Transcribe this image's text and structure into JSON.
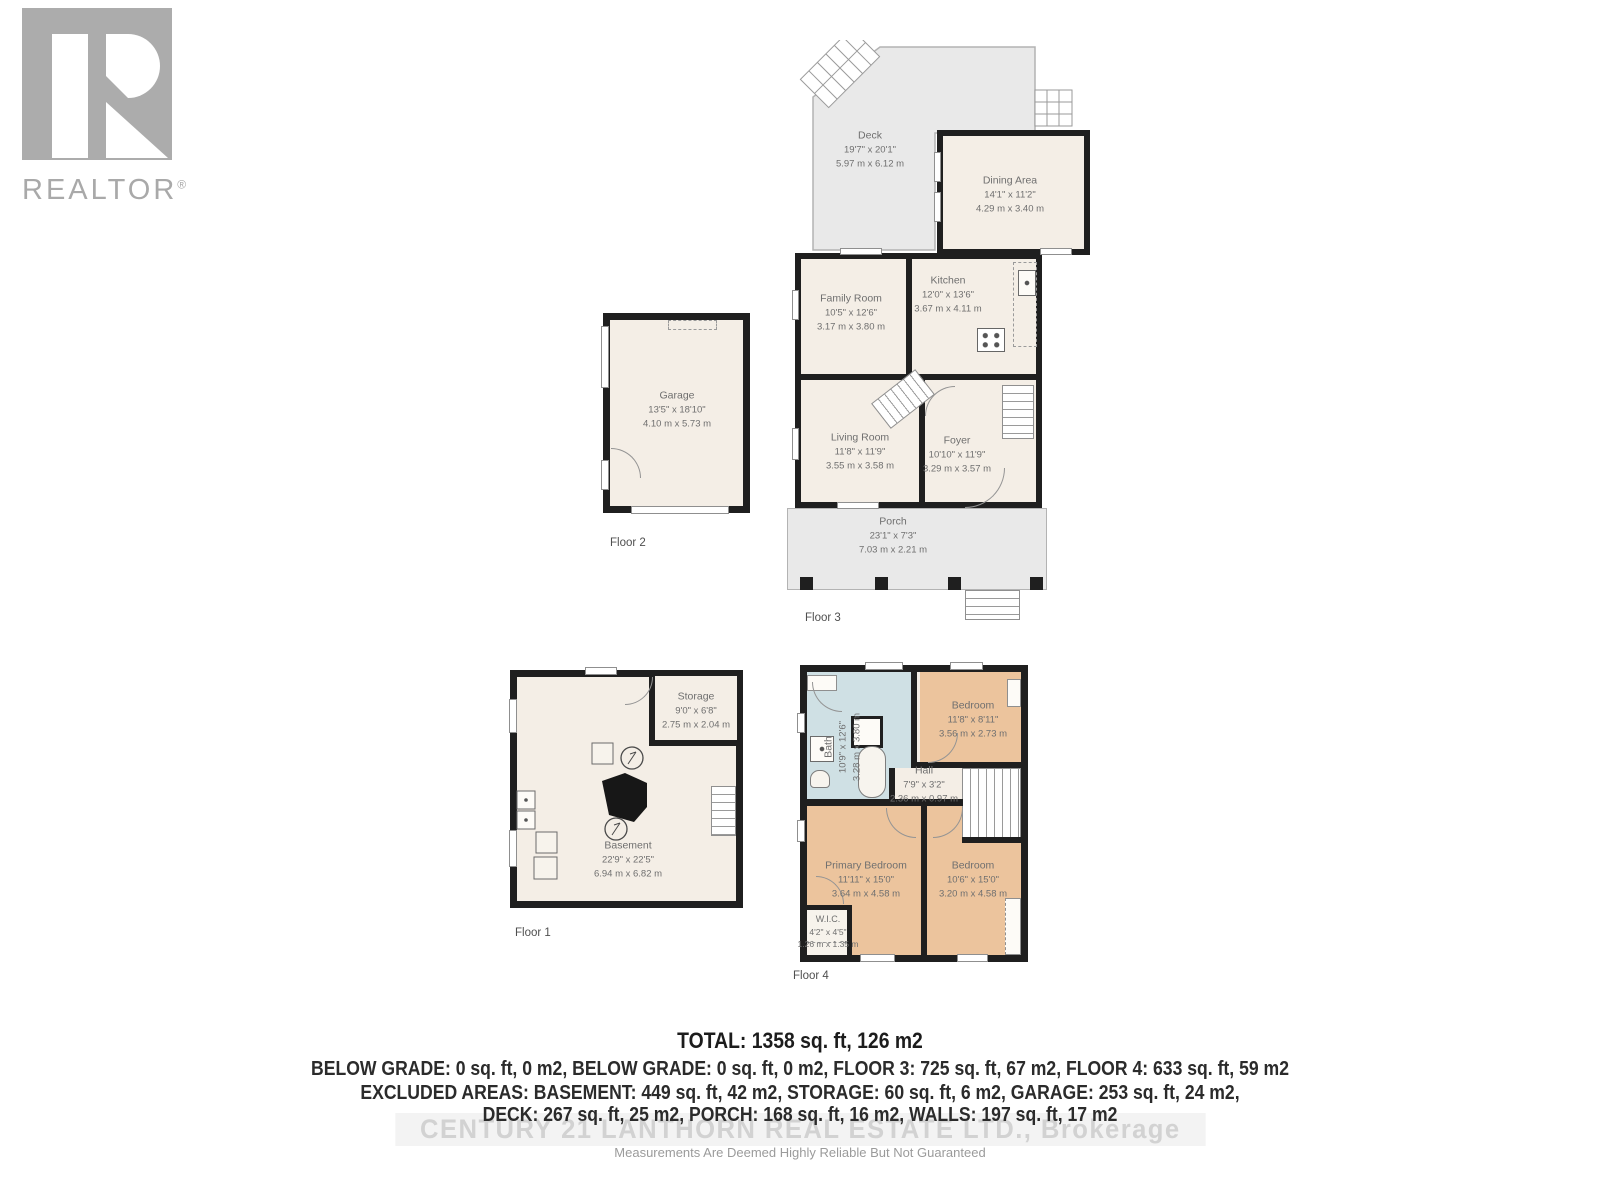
{
  "logo": {
    "brand": "REALTOR",
    "registered": "®"
  },
  "floors": [
    {
      "label": "Floor 3",
      "rooms": [
        {
          "name": "Deck",
          "imperial": "19'7\" x 20'1\"",
          "metric": "5.97 m x 6.12 m"
        },
        {
          "name": "Dining Area",
          "imperial": "14'1\" x 11'2\"",
          "metric": "4.29 m x 3.40 m"
        },
        {
          "name": "Family Room",
          "imperial": "10'5\" x 12'6\"",
          "metric": "3.17 m x 3.80 m"
        },
        {
          "name": "Kitchen",
          "imperial": "12'0\" x 13'6\"",
          "metric": "3.67 m x 4.11 m"
        },
        {
          "name": "Living Room",
          "imperial": "11'8\" x 11'9\"",
          "metric": "3.55 m x 3.58 m"
        },
        {
          "name": "Foyer",
          "imperial": "10'10\" x 11'9\"",
          "metric": "3.29 m x 3.57 m"
        },
        {
          "name": "Porch",
          "imperial": "23'1\" x 7'3\"",
          "metric": "7.03 m x 2.21 m"
        }
      ]
    },
    {
      "label": "Floor 2",
      "rooms": [
        {
          "name": "Garage",
          "imperial": "13'5\" x 18'10\"",
          "metric": "4.10 m x 5.73 m"
        }
      ]
    },
    {
      "label": "Floor 1",
      "rooms": [
        {
          "name": "Storage",
          "imperial": "9'0\" x 6'8\"",
          "metric": "2.75 m x 2.04 m"
        },
        {
          "name": "Basement",
          "imperial": "22'9\" x 22'5\"",
          "metric": "6.94 m x 6.82 m"
        }
      ]
    },
    {
      "label": "Floor 4",
      "rooms": [
        {
          "name": "Bath",
          "imperial": "10'9\" x 12'6\"",
          "metric": "3.28 m x 3.80 m"
        },
        {
          "name": "Bedroom",
          "imperial": "11'8\" x 8'11\"",
          "metric": "3.56 m x 2.73 m"
        },
        {
          "name": "Hall",
          "imperial": "7'9\" x 3'2\"",
          "metric": "2.36 m x 0.97 m"
        },
        {
          "name": "Primary Bedroom",
          "imperial": "11'11\" x 15'0\"",
          "metric": "3.64 m x 4.58 m"
        },
        {
          "name": "Bedroom",
          "imperial": "10'6\" x 15'0\"",
          "metric": "3.20 m x 4.58 m"
        },
        {
          "name": "W.I.C.",
          "imperial": "4'2\" x 4'5\"",
          "metric": "1.26 m x 1.35 m"
        }
      ]
    }
  ],
  "summary": {
    "total": "TOTAL: 1358 sq. ft, 126 m2",
    "line2": "BELOW GRADE: 0 sq. ft, 0 m2, BELOW GRADE: 0 sq. ft, 0 m2, FLOOR 3: 725 sq. ft, 67 m2, FLOOR 4: 633 sq. ft, 59 m2",
    "line3": "EXCLUDED AREAS: BASEMENT: 449 sq. ft, 42 m2, STORAGE: 60 sq. ft, 6 m2, GARAGE: 253 sq. ft, 24 m2,",
    "line4": "DECK: 267 sq. ft, 25 m2, PORCH: 168 sq. ft, 16 m2, WALLS: 197 sq. ft, 17 m2"
  },
  "watermark": "CENTURY 21 LANTHORN REAL ESTATE LTD., Brokerage",
  "disclaimer": "Measurements Are Deemed Highly Reliable But Not Guaranteed",
  "colors": {
    "wall": "#1f1f1f",
    "room_fill": "#f4eee6",
    "outdoor_fill": "#e9e9e9",
    "bedroom_fill": "#ecc49d",
    "bath_fill": "#cfe0e4",
    "label_text": "#6f6f6f",
    "watermark_text": "#d2d2d2"
  }
}
